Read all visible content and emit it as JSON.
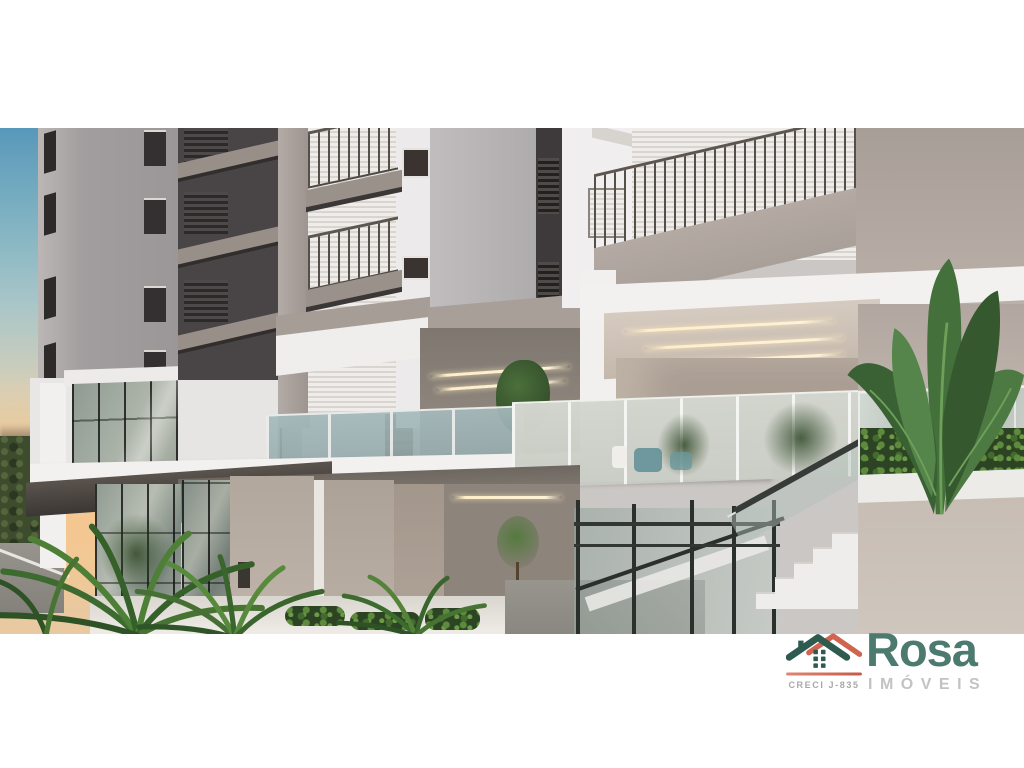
{
  "meta": {
    "type": "architectural-render-photo",
    "subject": "Modern residential building exterior: stacked balconies with metal railings, roller shutters, glass balustrades, covered terrace with linear LED ceiling lights, external stair with glass guardrail, tropical landscaping, sunset sky at left"
  },
  "logo": {
    "brand": "Rosa",
    "subtitle": "IMÓVEIS",
    "license": "CRECI J-835",
    "icon": "house-logo-icon",
    "colors": {
      "brand_green": "#4c7a6e",
      "roof_teal": "#2e5a50",
      "accent_red": "#cf6450",
      "subtitle_gray": "#c3c3c3",
      "license_gray": "#a8a8a8"
    }
  },
  "palette": {
    "sky_blue": "#5898ba",
    "sunset_peach": "#f3c795",
    "wall_light": "#eceaeb",
    "wall_taupe": "#ab9f98",
    "charcoal": "#474243",
    "slab_white": "#f1f0ef",
    "glass_green": "#9fb3ac",
    "foliage_dark": "#2f5526",
    "foliage_light": "#6f9a4e",
    "led_warm": "#f9ecd2"
  },
  "layout": {
    "top_white_band_px": 128,
    "photo_height_px": 506,
    "bottom_white_band_px": 134
  }
}
